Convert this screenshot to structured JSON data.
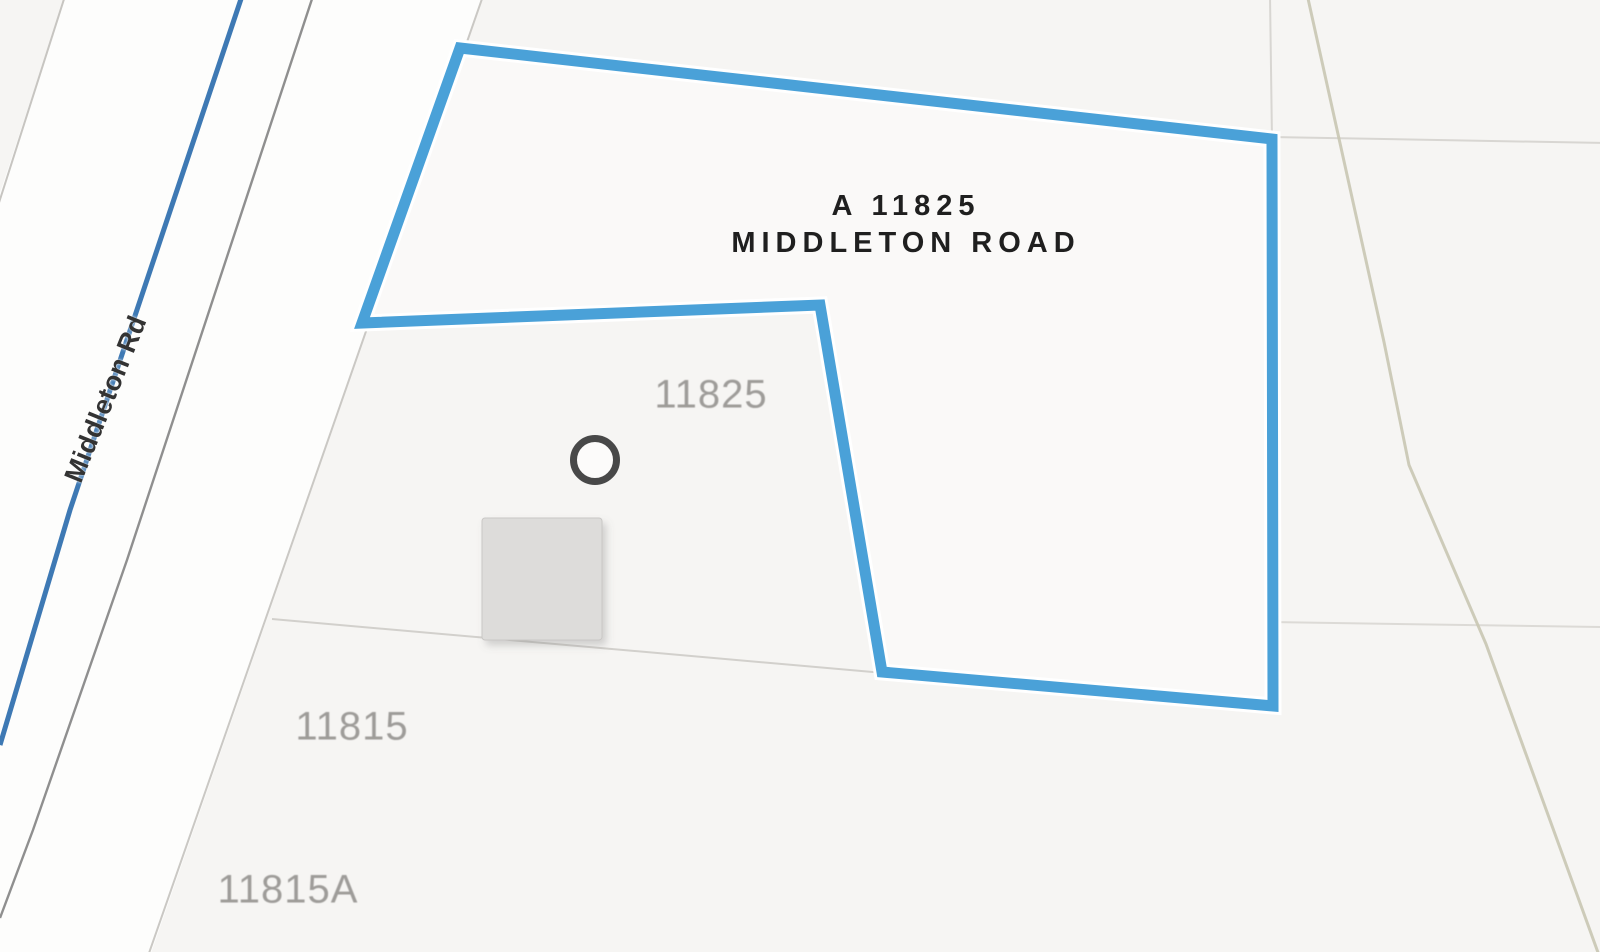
{
  "map": {
    "title": {
      "line1": "A 11825",
      "line2": "MIDDLETON ROAD"
    },
    "road_label": "Middleton Rd",
    "parcels": [
      {
        "label": "11825"
      },
      {
        "label": "11815"
      },
      {
        "label": "11815A"
      }
    ],
    "markers": {
      "building_footprint": "gray-square",
      "point_marker": "circle-outline"
    },
    "colors": {
      "background": "#f6f5f3",
      "road_surface": "#fdfdfc",
      "road_centerline_blue": "#3e79b4",
      "road_casing_dark": "#8f8f8f",
      "road_casing_light": "#c7c5c1",
      "parcel_boundary_light": "#cac8c4",
      "parcel_line_faint": "#d6d4d0",
      "contour_beige": "#c9c6b2",
      "highlight_outline_blue": "#4aa1d8",
      "building_fill": "#dddcda",
      "marker_stroke": "#484848",
      "parcel_label_gray": "#9e9c99",
      "title_color": "#1f1f1f"
    }
  }
}
